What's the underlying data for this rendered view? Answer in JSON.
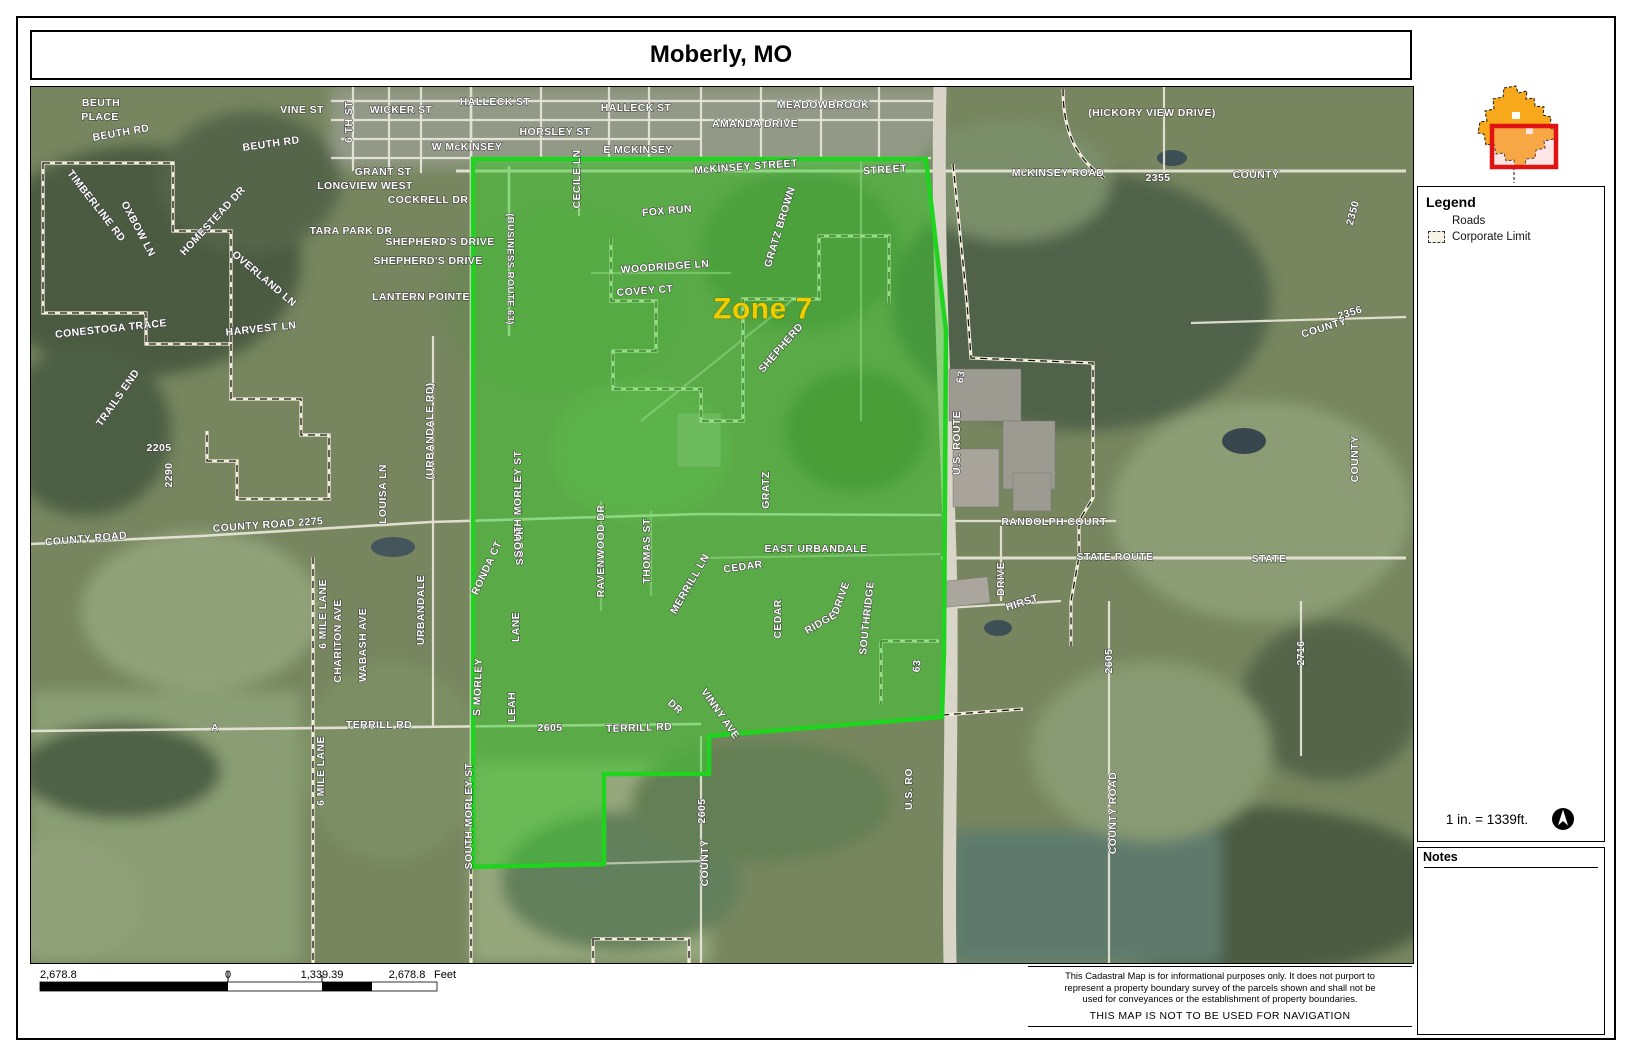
{
  "title": "Moberly, MO",
  "legend": {
    "title": "Legend",
    "items": [
      {
        "label": "Roads",
        "symbol": "road-line"
      },
      {
        "label": "Corporate Limit",
        "symbol": "dashed-box"
      }
    ]
  },
  "scale": {
    "text": "1 in. = 1339ft."
  },
  "notes": {
    "title": "Notes"
  },
  "scalebar": {
    "left": "2,678.8",
    "zero": "0",
    "mid": "1,339.39",
    "right": "2,678.8",
    "unit": "Feet"
  },
  "disclaimer": {
    "lines": [
      "This Cadastral Map is for informational purposes only.  It does not purport to",
      "represent a property boundary survey of the parcels shown and shall not be",
      "used for conveyances or the establishment of property boundaries."
    ],
    "warning": "THIS MAP IS NOT TO BE USED FOR NAVIGATION"
  },
  "colors": {
    "zone_fill": "#3ecd30",
    "zone_border": "#1ed41e",
    "inset_city": "#f7a81b",
    "inset_highlight": "#e01212",
    "label_yellow": "#f0cd00"
  },
  "map": {
    "labels": [
      {
        "t": "BEUTH",
        "x": 100,
        "y": 102
      },
      {
        "t": "PLACE",
        "x": 99,
        "y": 116
      },
      {
        "t": "BEUTH RD",
        "x": 120,
        "y": 132,
        "r": -10
      },
      {
        "t": "BEUTH RD",
        "x": 270,
        "y": 143,
        "r": -8
      },
      {
        "t": "VINE ST",
        "x": 301,
        "y": 109
      },
      {
        "t": "6 TH ST",
        "x": 348,
        "y": 121,
        "r": -90
      },
      {
        "t": "TIMBERLINE RD",
        "x": 95,
        "y": 205,
        "r": 52
      },
      {
        "t": "OXBOW LN",
        "x": 137,
        "y": 228,
        "r": 62
      },
      {
        "t": "HOMESTEAD DR",
        "x": 212,
        "y": 220,
        "r": -47
      },
      {
        "t": "OVERLAND LN",
        "x": 263,
        "y": 278,
        "r": 40
      },
      {
        "t": "CONESTOGA TRACE",
        "x": 110,
        "y": 328,
        "r": -6
      },
      {
        "t": "HARVEST LN",
        "x": 260,
        "y": 328,
        "r": -6
      },
      {
        "t": "TRAILS END",
        "x": 117,
        "y": 397,
        "r": -55
      },
      {
        "t": "GRANT ST",
        "x": 382,
        "y": 171
      },
      {
        "t": "LONGVIEW WEST",
        "x": 364,
        "y": 185
      },
      {
        "t": "TARA PARK DR",
        "x": 350,
        "y": 230
      },
      {
        "t": "COCKRELL DR",
        "x": 427,
        "y": 199
      },
      {
        "t": "SHEPHERD'S DRIVE",
        "x": 439,
        "y": 241
      },
      {
        "t": "SHEPHERD'S DRIVE",
        "x": 427,
        "y": 260
      },
      {
        "t": "LANTERN POINTE",
        "x": 420,
        "y": 296
      },
      {
        "t": "WICKER ST",
        "x": 400,
        "y": 109
      },
      {
        "t": "HALLECK ST",
        "x": 494,
        "y": 101
      },
      {
        "t": "HALLECK ST",
        "x": 635,
        "y": 107
      },
      {
        "t": "HORSLEY ST",
        "x": 554,
        "y": 131
      },
      {
        "t": "W McKINSEY",
        "x": 466,
        "y": 146
      },
      {
        "t": "E MCKINSEY",
        "x": 637,
        "y": 149
      },
      {
        "t": "MEADOWBROOK",
        "x": 822,
        "y": 104
      },
      {
        "t": "AMANDA DRIVE",
        "x": 754,
        "y": 123
      },
      {
        "t": "McKINSEY STREET",
        "x": 745,
        "y": 166,
        "r": -4
      },
      {
        "t": "STREET",
        "x": 884,
        "y": 169,
        "r": -4
      },
      {
        "t": "CECILE LN",
        "x": 576,
        "y": 178,
        "r": -90
      },
      {
        "t": "(HICKORY VIEW DRIVE)",
        "x": 1151,
        "y": 112
      },
      {
        "t": "McKINSEY ROAD",
        "x": 1057,
        "y": 172
      },
      {
        "t": "2355",
        "x": 1157,
        "y": 177
      },
      {
        "t": "COUNTY",
        "x": 1255,
        "y": 174
      },
      {
        "t": "2350",
        "x": 1352,
        "y": 212,
        "r": -75
      },
      {
        "t": "COUNTY",
        "x": 1323,
        "y": 327,
        "r": -17
      },
      {
        "t": "2356",
        "x": 1349,
        "y": 312,
        "r": -17
      },
      {
        "t": "COUNTY",
        "x": 1354,
        "y": 458,
        "r": -90
      },
      {
        "t": "2205",
        "x": 158,
        "y": 447
      },
      {
        "t": "2290",
        "x": 168,
        "y": 474,
        "r": -90
      },
      {
        "t": "COUNTY ROAD",
        "x": 85,
        "y": 538,
        "r": -5
      },
      {
        "t": "COUNTY ROAD 2275",
        "x": 267,
        "y": 524,
        "r": -4
      },
      {
        "t": "LOUISA LN",
        "x": 382,
        "y": 493,
        "r": -90
      },
      {
        "t": "(URBANDALE RD)",
        "x": 429,
        "y": 430,
        "r": -90
      },
      {
        "t": "URBANDALE",
        "x": 420,
        "y": 609,
        "r": -90
      },
      {
        "t": "6 MILE LANE",
        "x": 322,
        "y": 613,
        "r": -90
      },
      {
        "t": "CHARITON AVE",
        "x": 337,
        "y": 640,
        "r": -90
      },
      {
        "t": "WABASH AVE",
        "x": 362,
        "y": 644,
        "r": -90
      },
      {
        "t": "6 MILE LANE",
        "x": 320,
        "y": 770,
        "r": -90
      },
      {
        "t": "A",
        "x": 214,
        "y": 727
      },
      {
        "t": "TERRILL RD",
        "x": 378,
        "y": 724
      },
      {
        "t": "TERRILL RD",
        "x": 638,
        "y": 727,
        "r": -2
      },
      {
        "t": "2605",
        "x": 549,
        "y": 727
      },
      {
        "t": "SOUTH MORLEY ST",
        "x": 468,
        "y": 815,
        "r": -90
      },
      {
        "t": "S MORLEY",
        "x": 477,
        "y": 686,
        "r": -88
      },
      {
        "t": "LEAH",
        "x": 511,
        "y": 706,
        "r": -90
      },
      {
        "t": "RONDA CT",
        "x": 486,
        "y": 567,
        "r": -65
      },
      {
        "t": "SOUTH",
        "x": 519,
        "y": 545,
        "r": -90
      },
      {
        "t": "LANE",
        "x": 515,
        "y": 626,
        "r": -90
      },
      {
        "t": "SOUTH MORLEY ST",
        "x": 517,
        "y": 503,
        "r": -90
      },
      {
        "t": "RAVENWOOD DR",
        "x": 600,
        "y": 550,
        "r": -90
      },
      {
        "t": "THOMAS ST",
        "x": 646,
        "y": 550,
        "r": -90
      },
      {
        "t": "MERRILL LN",
        "x": 689,
        "y": 583,
        "r": -60
      },
      {
        "t": "GRATZ",
        "x": 765,
        "y": 489,
        "r": -90
      },
      {
        "t": "EAST URBANDALE",
        "x": 815,
        "y": 548
      },
      {
        "t": "CEDAR",
        "x": 742,
        "y": 566,
        "r": -8
      },
      {
        "t": "CEDAR",
        "x": 777,
        "y": 618,
        "r": -90
      },
      {
        "t": "RIDGE",
        "x": 820,
        "y": 622,
        "r": -30
      },
      {
        "t": "DRIVE",
        "x": 840,
        "y": 597,
        "r": -70
      },
      {
        "t": "SOUTHRIDGE",
        "x": 866,
        "y": 617,
        "r": -84
      },
      {
        "t": "VINNY AVE",
        "x": 719,
        "y": 713,
        "r": 55
      },
      {
        "t": "DR",
        "x": 674,
        "y": 706,
        "r": 42
      },
      {
        "t": "2605",
        "x": 701,
        "y": 810,
        "r": -90
      },
      {
        "t": "COUNTY",
        "x": 704,
        "y": 862,
        "r": -90
      },
      {
        "t": "WOODRIDGE LN",
        "x": 664,
        "y": 266,
        "r": -4
      },
      {
        "t": "COVEY CT",
        "x": 644,
        "y": 290,
        "r": -4
      },
      {
        "t": "FOX RUN",
        "x": 666,
        "y": 210,
        "r": -5
      },
      {
        "t": "GRATZ BROWN",
        "x": 779,
        "y": 226,
        "r": -73
      },
      {
        "t": "SHEPHERD",
        "x": 780,
        "y": 347,
        "r": -49
      },
      {
        "t": "63",
        "x": 960,
        "y": 376,
        "r": -80
      },
      {
        "t": "U.S. ROUTE",
        "x": 956,
        "y": 442,
        "r": -90
      },
      {
        "t": "63",
        "x": 916,
        "y": 665,
        "r": -85
      },
      {
        "t": "U.S. RO",
        "x": 908,
        "y": 788,
        "r": -90
      },
      {
        "t": "RANDOLPH COURT",
        "x": 1053,
        "y": 521
      },
      {
        "t": "STATE ROUTE",
        "x": 1114,
        "y": 556
      },
      {
        "t": "STATE",
        "x": 1268,
        "y": 558
      },
      {
        "t": "DRIVE",
        "x": 1000,
        "y": 578,
        "r": -90
      },
      {
        "t": "HIRST",
        "x": 1021,
        "y": 602,
        "r": -18
      },
      {
        "t": "2716",
        "x": 1300,
        "y": 652,
        "r": -90
      },
      {
        "t": "2605",
        "x": 1108,
        "y": 660,
        "r": -90
      },
      {
        "t": "COUNTY ROAD",
        "x": 1112,
        "y": 812,
        "r": -90
      },
      {
        "t": "(BUSINESS ROUTE 63)",
        "x": 509,
        "y": 268,
        "r": 90,
        "s": 9.5
      },
      {
        "t": "Zone 7",
        "x": 762,
        "y": 308,
        "s": 30,
        "c": "#f0cd00",
        "cls": "zonelbl",
        "name": "zone-7-label"
      }
    ]
  }
}
